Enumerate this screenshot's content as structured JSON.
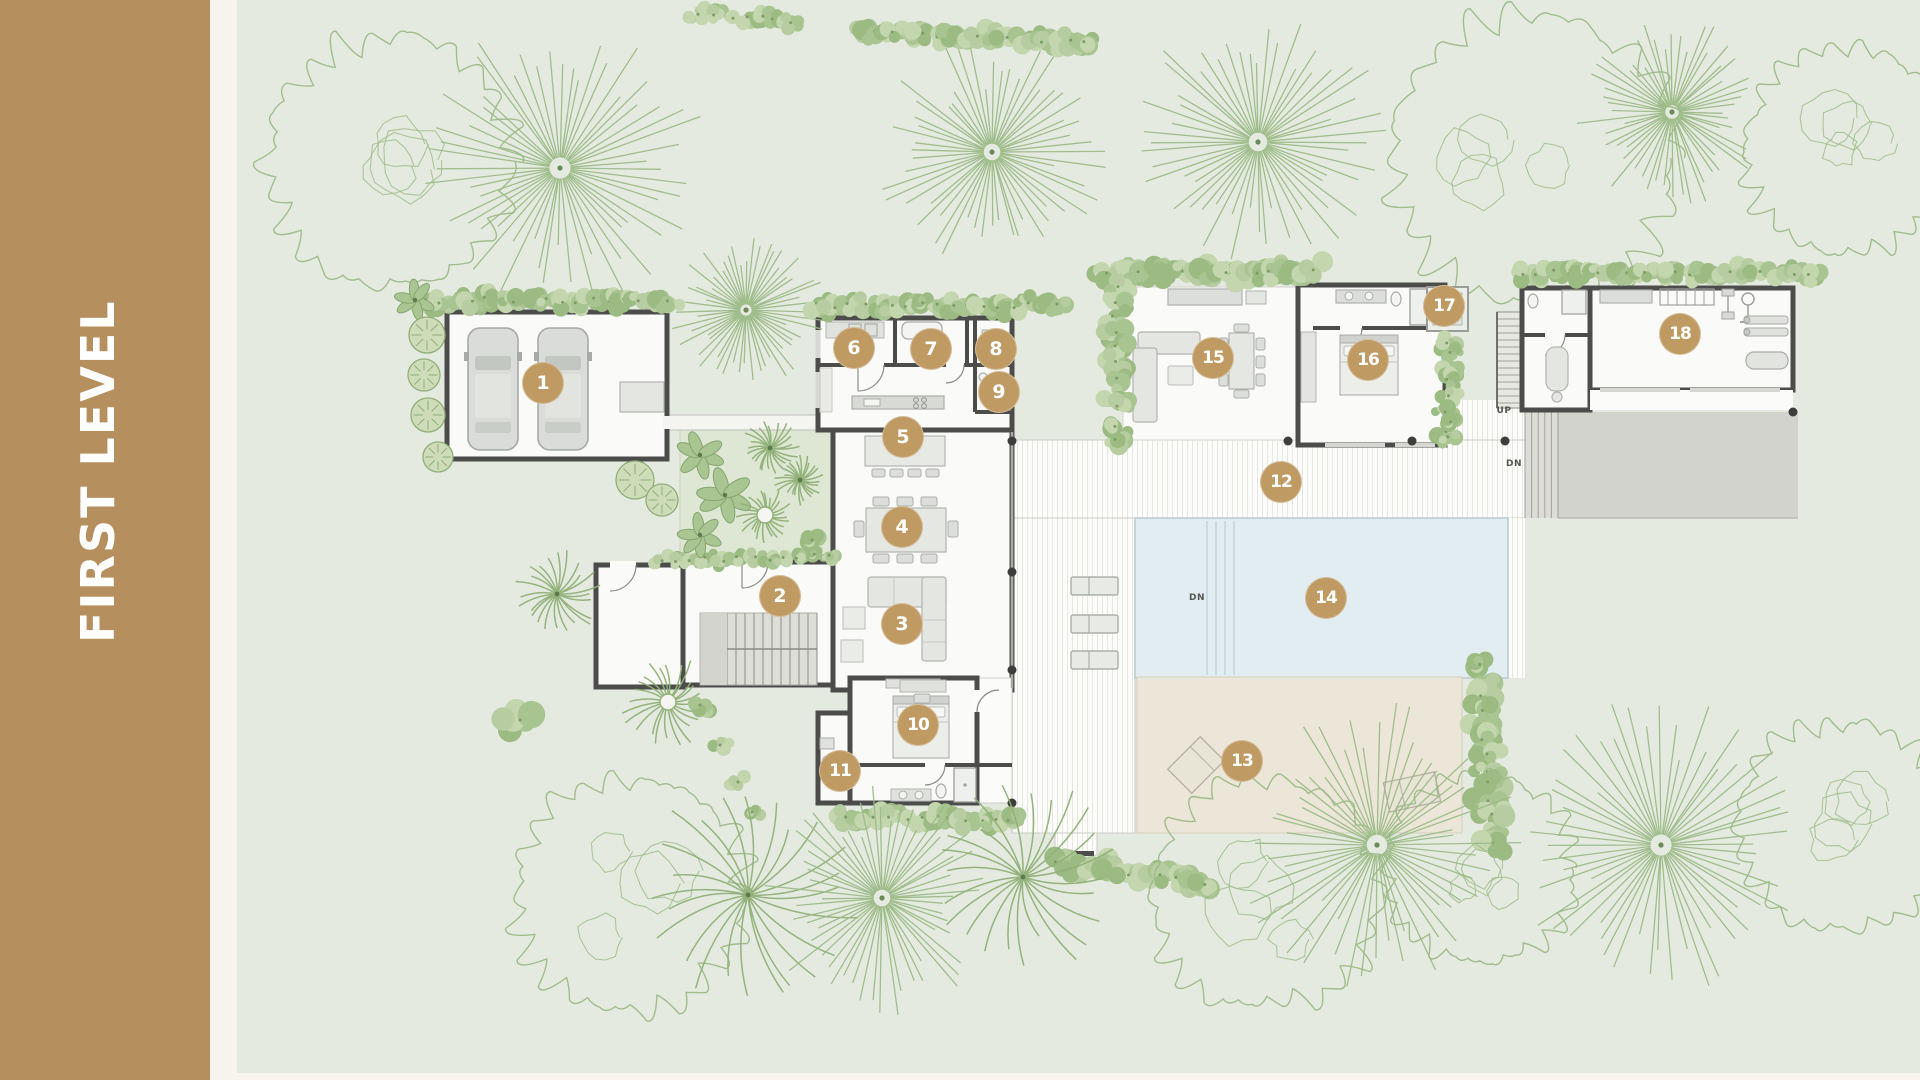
{
  "sidebar": {
    "title": "FIRST LEVEL"
  },
  "colors": {
    "sidebar_bg": "#b68f5e",
    "gutter": "#f7f4ed",
    "ground": "#e5eae1",
    "marker_bg": "#bf9a63",
    "marker_text": "#ffffff",
    "wall": "#4c4c4a",
    "building_fill": "#fafaf8",
    "pool": "#e2edf2",
    "pool_edge": "#b9c9cf",
    "patio": "#ebe6d7",
    "terrace": "#d2d3cd",
    "deck": "#fcfcfa",
    "deck_stripe": "#e7e7e2",
    "courtyard": "#dde7d3",
    "tree": "#9cbb87",
    "hedge": "#aec98f",
    "furniture": "#e4e6e2",
    "label_text": "#55554f"
  },
  "markers": [
    {
      "n": "1",
      "x": 543,
      "y": 383
    },
    {
      "n": "2",
      "x": 780,
      "y": 596
    },
    {
      "n": "3",
      "x": 902,
      "y": 624
    },
    {
      "n": "4",
      "x": 902,
      "y": 527
    },
    {
      "n": "5",
      "x": 903,
      "y": 437
    },
    {
      "n": "6",
      "x": 854,
      "y": 348
    },
    {
      "n": "7",
      "x": 931,
      "y": 349
    },
    {
      "n": "8",
      "x": 996,
      "y": 349
    },
    {
      "n": "9",
      "x": 999,
      "y": 392
    },
    {
      "n": "10",
      "x": 918,
      "y": 725
    },
    {
      "n": "11",
      "x": 840,
      "y": 771
    },
    {
      "n": "12",
      "x": 1281,
      "y": 482
    },
    {
      "n": "13",
      "x": 1242,
      "y": 761
    },
    {
      "n": "14",
      "x": 1326,
      "y": 598
    },
    {
      "n": "15",
      "x": 1213,
      "y": 358
    },
    {
      "n": "16",
      "x": 1368,
      "y": 360
    },
    {
      "n": "17",
      "x": 1444,
      "y": 306
    },
    {
      "n": "18",
      "x": 1680,
      "y": 334
    }
  ],
  "plan_labels": [
    {
      "text": "UP",
      "x": 1504,
      "y": 411
    },
    {
      "text": "DN",
      "x": 1514,
      "y": 464
    },
    {
      "text": "DN",
      "x": 1197,
      "y": 598
    }
  ]
}
